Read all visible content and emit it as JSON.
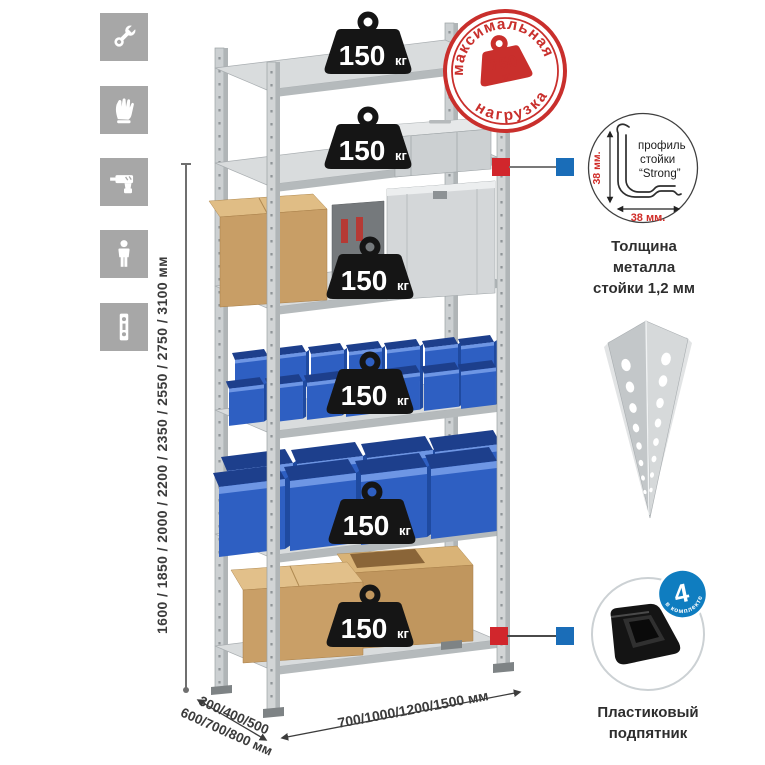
{
  "sidebar": {
    "icons": [
      {
        "name": "wrench-icon"
      },
      {
        "name": "gloves-icon"
      },
      {
        "name": "drill-icon"
      },
      {
        "name": "person-icon"
      },
      {
        "name": "level-icon"
      }
    ]
  },
  "dimensions": {
    "height_label": "1600 / 1850 / 2000 / 2200 / 2350 / 2550 / 2750 / 3100 мм",
    "depth_label_line1": "300/400/500",
    "depth_label_line2": "600/700/800 мм",
    "width_label": "700/1000/1200/1500 мм"
  },
  "max_load_stamp": {
    "arc_top": "максимальная",
    "arc_bottom": "нагрузка",
    "value": "750",
    "unit": "кг"
  },
  "shelf_load": {
    "value": "150",
    "unit": "кг",
    "shelf_count": 6
  },
  "post_profile_detail": {
    "dim_vertical": "38 мм.",
    "dim_horizontal": "38 мм.",
    "label_line1": "профиль",
    "label_line2": "стойки",
    "label_line3": "“Strong”",
    "caption_line1": "Толщина металла",
    "caption_line2": "стойки 1,2 мм"
  },
  "foot_detail": {
    "badge_value": "4",
    "badge_arc": "в комплекте",
    "caption_line1": "Пластиковый",
    "caption_line2": "подпятник"
  },
  "colors": {
    "accent_red": "#c92f2c",
    "marker_red": "#d1262c",
    "marker_blue": "#1a6db8",
    "badge_blue": "#0f7dc0",
    "bin_blue": "#2e5fc2",
    "metal_gray": "#d2d5d6",
    "icon_tile_gray": "#a7a7a7"
  }
}
